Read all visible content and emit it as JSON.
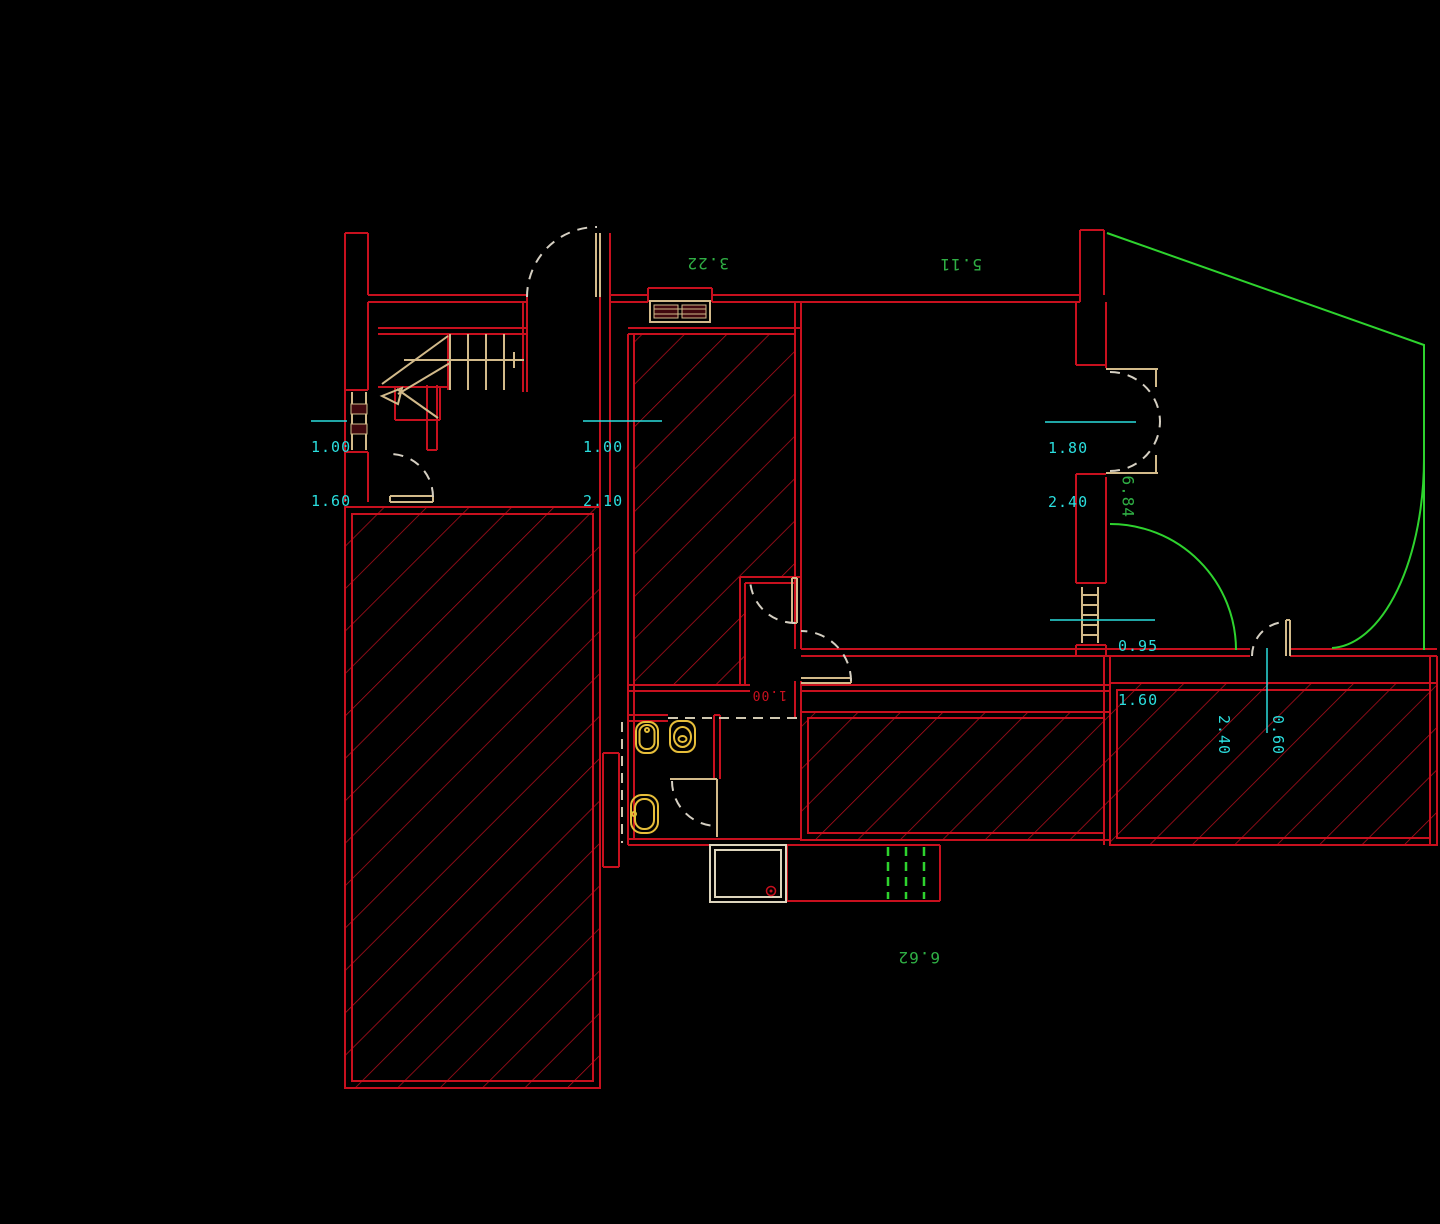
{
  "drawing": {
    "type": "floor-plan",
    "annotations": {
      "top_width_left": "3.22",
      "top_width_right": "5.11",
      "right_height": "6.84",
      "bottom_width": "6.62",
      "bath_door_width": "1.00"
    },
    "dimensions": {
      "left_window": {
        "above": "1.00",
        "below": "1.60"
      },
      "hall_door": {
        "above": "1.00",
        "below": "2.10"
      },
      "double_door": {
        "above": "1.80",
        "below": "2.40"
      },
      "right_window": {
        "above": "0.95",
        "below": "1.60"
      },
      "small_door": {
        "above": "0.60",
        "below": "2.40"
      }
    },
    "colors": {
      "background": "#000000",
      "wall": "#c8101e",
      "hatch": "#b5101e",
      "dimension_text": "#2adede",
      "annotation_text": "#2fae44",
      "boundary_green": "#2ed32e",
      "door_leaf_tan": "#d2ba8a",
      "swing_dash": "#d5cfc2",
      "fixture_yellow": "#e6be3a",
      "shower_tray": "#ddd5bd",
      "window_pane": "#40090e"
    },
    "symbols": [
      "staircase",
      "entry-door",
      "room-door",
      "double-door",
      "bathroom-door",
      "balcony-door",
      "window-left",
      "window-top",
      "window-right",
      "bidet",
      "toilet",
      "sink",
      "shower-tray",
      "drain-channel",
      "duct-shaft",
      "terrace-hatch-left",
      "room-hatch-center",
      "terrace-hatch-mid",
      "terrace-hatch-right"
    ]
  }
}
